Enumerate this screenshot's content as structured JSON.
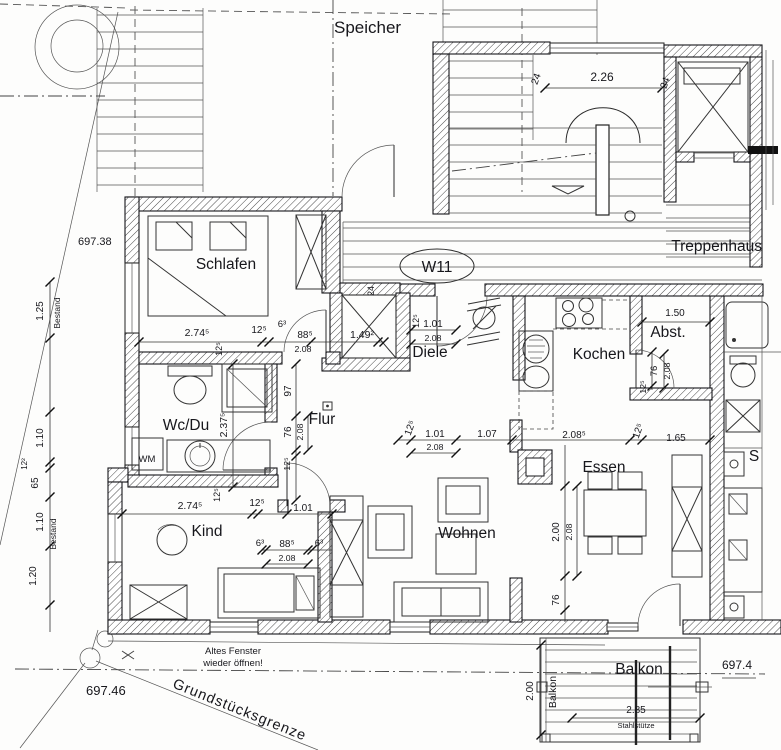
{
  "labels": {
    "speicher": "Speicher",
    "treppenhaus": "Treppenhaus",
    "unit": "W11",
    "schlafen": "Schlafen",
    "diele": "Diele",
    "kochen": "Kochen",
    "abstell": "Abst.",
    "wc_du": "Wc/Du",
    "flur": "Flur",
    "kind": "Kind",
    "wohnen": "Wohnen",
    "essen": "Essen",
    "balkon": "Balkon",
    "balkon_side": "Balkon",
    "neighbor_room": "S",
    "wm": "WM",
    "bestand_upper": "Bestand",
    "bestand_lower": "Bestand",
    "grundstuecksgrenze": "Grundstücksgrenze",
    "note_line1": "Altes Fenster",
    "note_line2": "wieder öffnen!",
    "stahlstuetze": "Stahlstütze"
  },
  "elevations": {
    "upper_left": "697.38",
    "lower_left": "697.46",
    "lower_right": "697.4"
  },
  "dims": {
    "wall_top_left": "24",
    "stair_width": "2.26",
    "wall_top_right": "24",
    "chimney_wall": "24",
    "schlafen_width": "2.74⁵",
    "schlafen_wall": "12⁵",
    "schlafen_door_jamb": "6³",
    "schlafen_door_w": "88⁵",
    "schlafen_door_h": "2.08",
    "shaft_width": "1.49²",
    "schlafen_wall_side": "12⁵",
    "diele_wall": "12⁵",
    "diele_door_w": "1.01",
    "diele_door_h": "2.08",
    "abst_width": "1.50",
    "abst_door_w": "76",
    "abst_door_h": "2.08",
    "abst_wall": "12⁵",
    "wcdu_depth": "2.37⁵",
    "wcdu_wall_top": "12⁵",
    "wcdu_wall_bottom": "12⁵",
    "flur_seg": "97",
    "wcdu_door_w": "76",
    "wcdu_door_h": "2.08",
    "flur_wall": "12⁵",
    "main_wall": "12⁵",
    "main_door_w": "1.01",
    "main_door_h": "2.08",
    "main_opening": "1.07",
    "living_opening": "2.08⁵",
    "essen_wall": "12⁵",
    "essen_width": "1.65",
    "kind_width": "2.74⁵",
    "kind_wall": "12⁵",
    "kind_door": "1.01",
    "kind_door_jamb_l": "6³",
    "kind_door_w": "88⁵",
    "kind_door_jamb_r": "6³",
    "kind_door_h": "2.08",
    "essen_opening_h": "2.00",
    "essen_opening_h2": "2.08",
    "essen_pier": "76",
    "balkon_depth": "2.00",
    "balkon_width": "2.85",
    "left_1": "1.25",
    "left_2": "1.10",
    "left_3": "12²",
    "left_4": "65",
    "left_5": "1.10",
    "left_6": "1.20"
  }
}
